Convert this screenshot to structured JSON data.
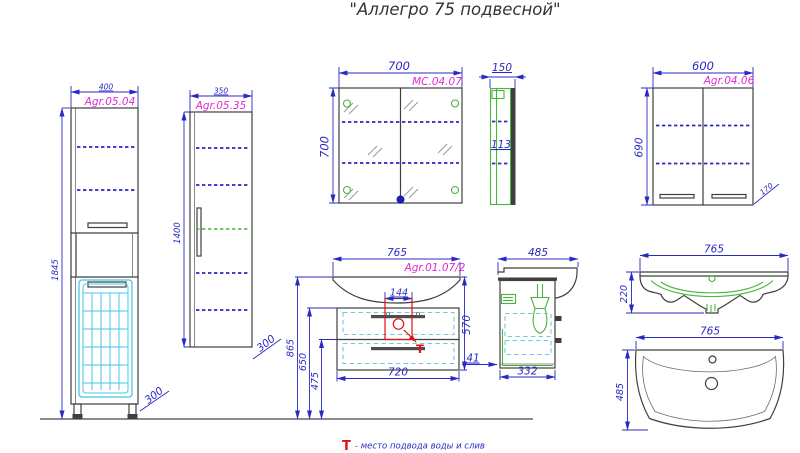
{
  "title": "\"Аллегро 75 подвесной\"",
  "legend": {
    "symbol": "Т",
    "text": "- место подвода воды и слив"
  },
  "colors": {
    "dimension_blue": "#2a2ac2",
    "code_magenta": "#e02ad0",
    "outline_dark": "#3f3f3f",
    "basket_cyan": "#45c8e8",
    "detail_green": "#49b43c",
    "marker_red": "#e01010",
    "floor_gray": "#8c8c8c"
  },
  "drawings": {
    "tall_basket_cabinet": {
      "code": "Agr.05.04",
      "width_mm": "400",
      "height_mm": "1845",
      "depth_mm": "300"
    },
    "tall_column_cabinet": {
      "code": "Agr.05.35",
      "width_mm": "350",
      "height_mm": "1400",
      "depth_mm": "300"
    },
    "mirror_cabinet": {
      "code": "МС.04.07",
      "width_mm": "700",
      "height_mm": "700"
    },
    "mirror_cabinet_side": {
      "width_mm": "150",
      "shelf_depth_mm": "113"
    },
    "wall_cabinet": {
      "code": "Agr.04.06",
      "width_mm": "600",
      "height_mm": "690",
      "depth_mm": "170"
    },
    "vanity_front": {
      "code": "Agr.01.07/2",
      "width_mm": "765",
      "body_width_mm": "720",
      "height_mm": "570",
      "drain_zone_width_mm": "144",
      "height_to_top_mm": "865",
      "height_to_body_top_mm": "650",
      "height_to_divider_mm": "475",
      "wall_gap_mm": "41"
    },
    "vanity_side": {
      "width_mm": "485",
      "body_depth_mm": "332"
    },
    "basin_front": {
      "width_mm": "765",
      "height_mm": "220"
    },
    "basin_top": {
      "width_mm": "765",
      "depth_mm": "485"
    }
  }
}
